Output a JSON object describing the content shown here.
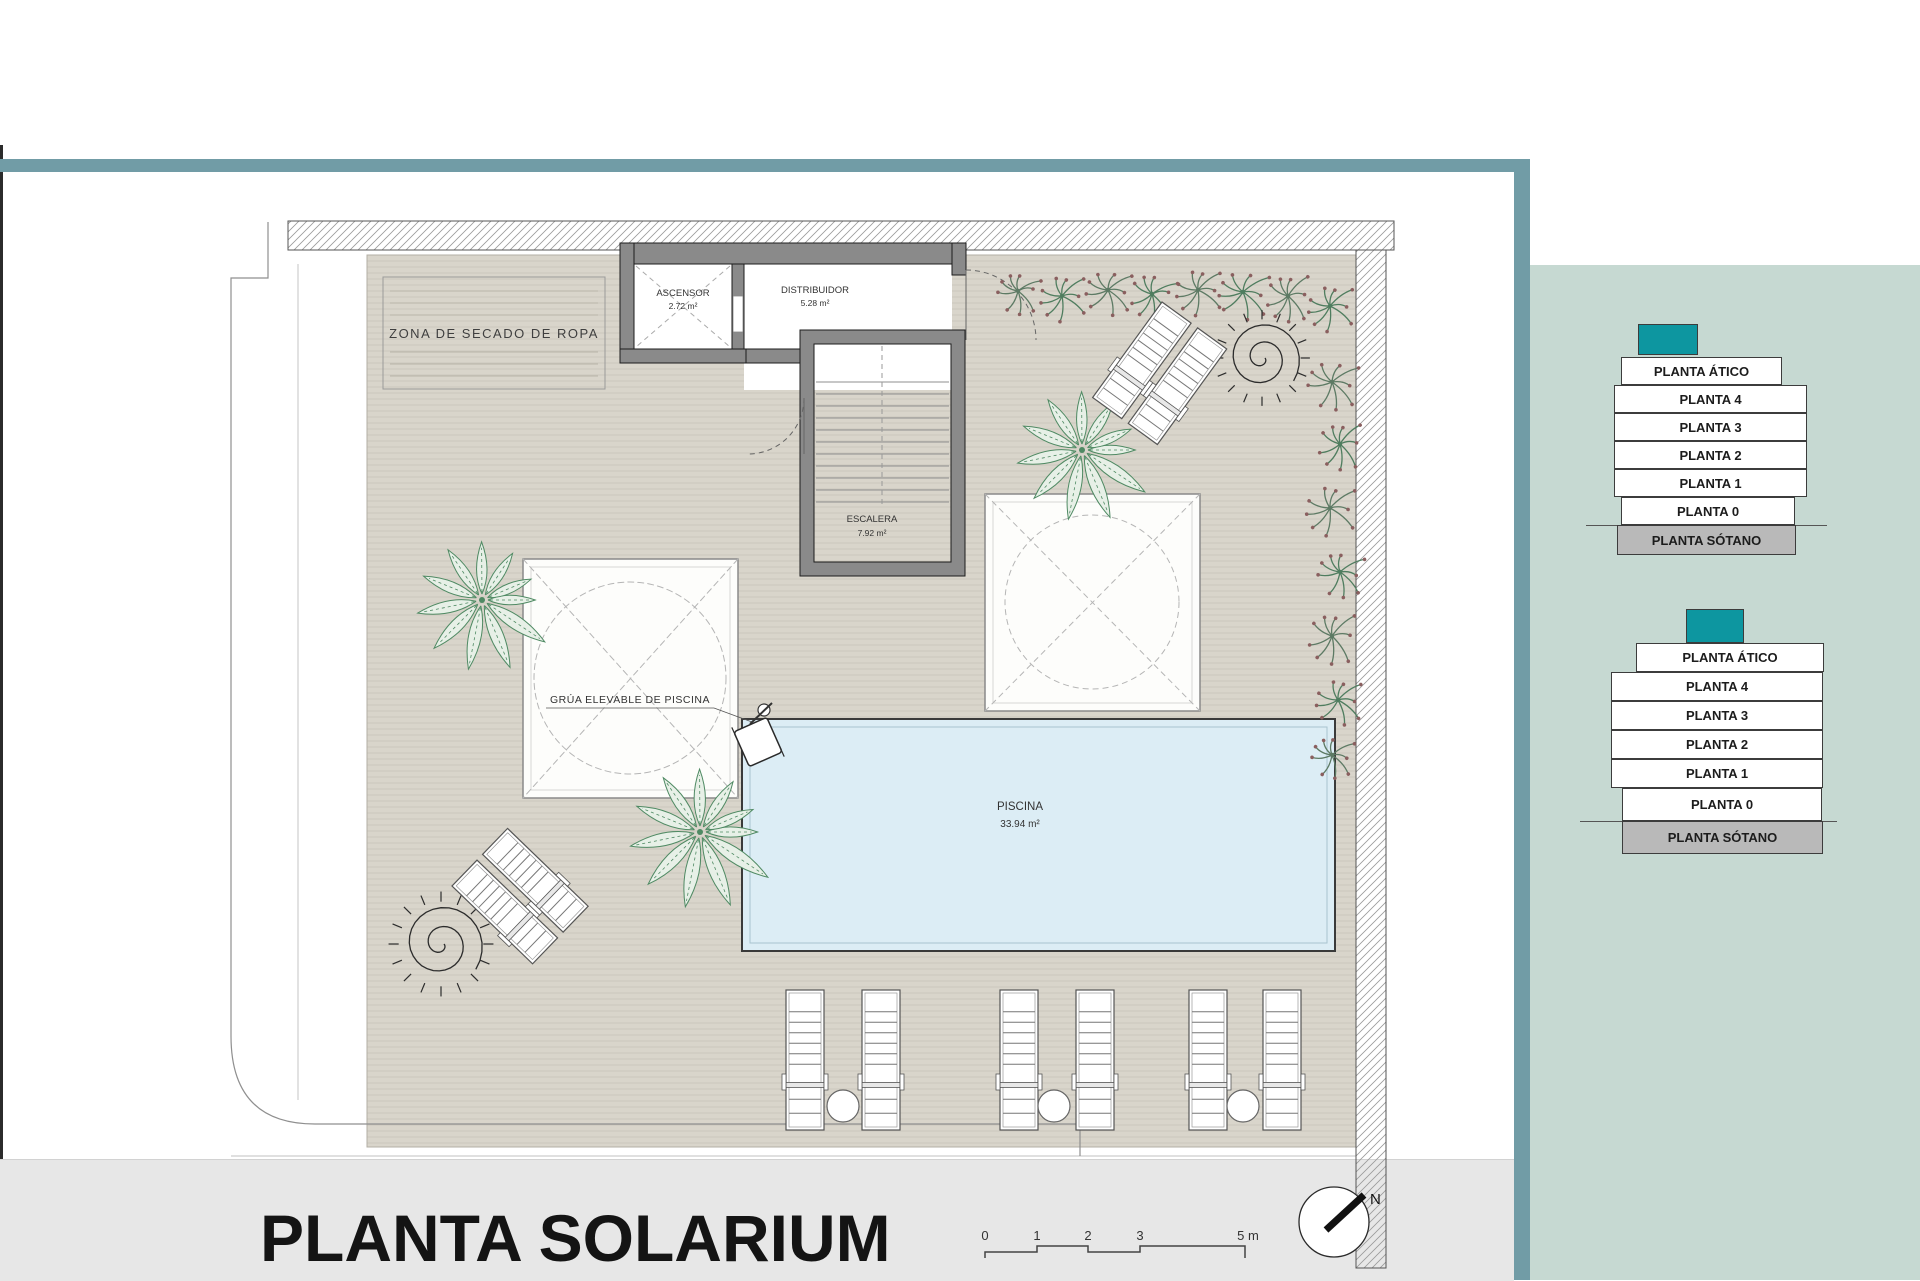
{
  "title": "PLANTA SOLARIUM",
  "plan": {
    "rooms": {
      "ascensor": {
        "label": "ASCENSOR",
        "area": "2.72 m²"
      },
      "distribuidor": {
        "label": "DISTRIBUIDOR",
        "area": "5.28 m²"
      },
      "escalera": {
        "label": "ESCALERA",
        "area": "7.92 m²"
      },
      "piscina": {
        "label": "PISCINA",
        "area": "33.94 m²"
      }
    },
    "annotations": {
      "drying_zone": "ZONA DE SECADO DE ROPA",
      "pool_crane": "GRÚA ELEVABLE DE PISCINA"
    }
  },
  "scale_bar": {
    "ticks": [
      "0",
      "1",
      "2",
      "3",
      "5 m"
    ]
  },
  "north_label": "N",
  "right_panel": {
    "levels": [
      "PLANTA ÁTICO",
      "PLANTA 4",
      "PLANTA 3",
      "PLANTA 2",
      "PLANTA 1",
      "PLANTA 0",
      "PLANTA SÓTANO"
    ]
  },
  "colors": {
    "frame_teal": "#719ca6",
    "panel_teal": "#c6d9d2",
    "block_teal": "#0d96a0",
    "sotano_grey": "#b9b9b9",
    "deck": "#d9d5cb",
    "pool": "#dcedf5",
    "wall": "#8a8a8a",
    "strip_grey": "#e7e7e7"
  }
}
